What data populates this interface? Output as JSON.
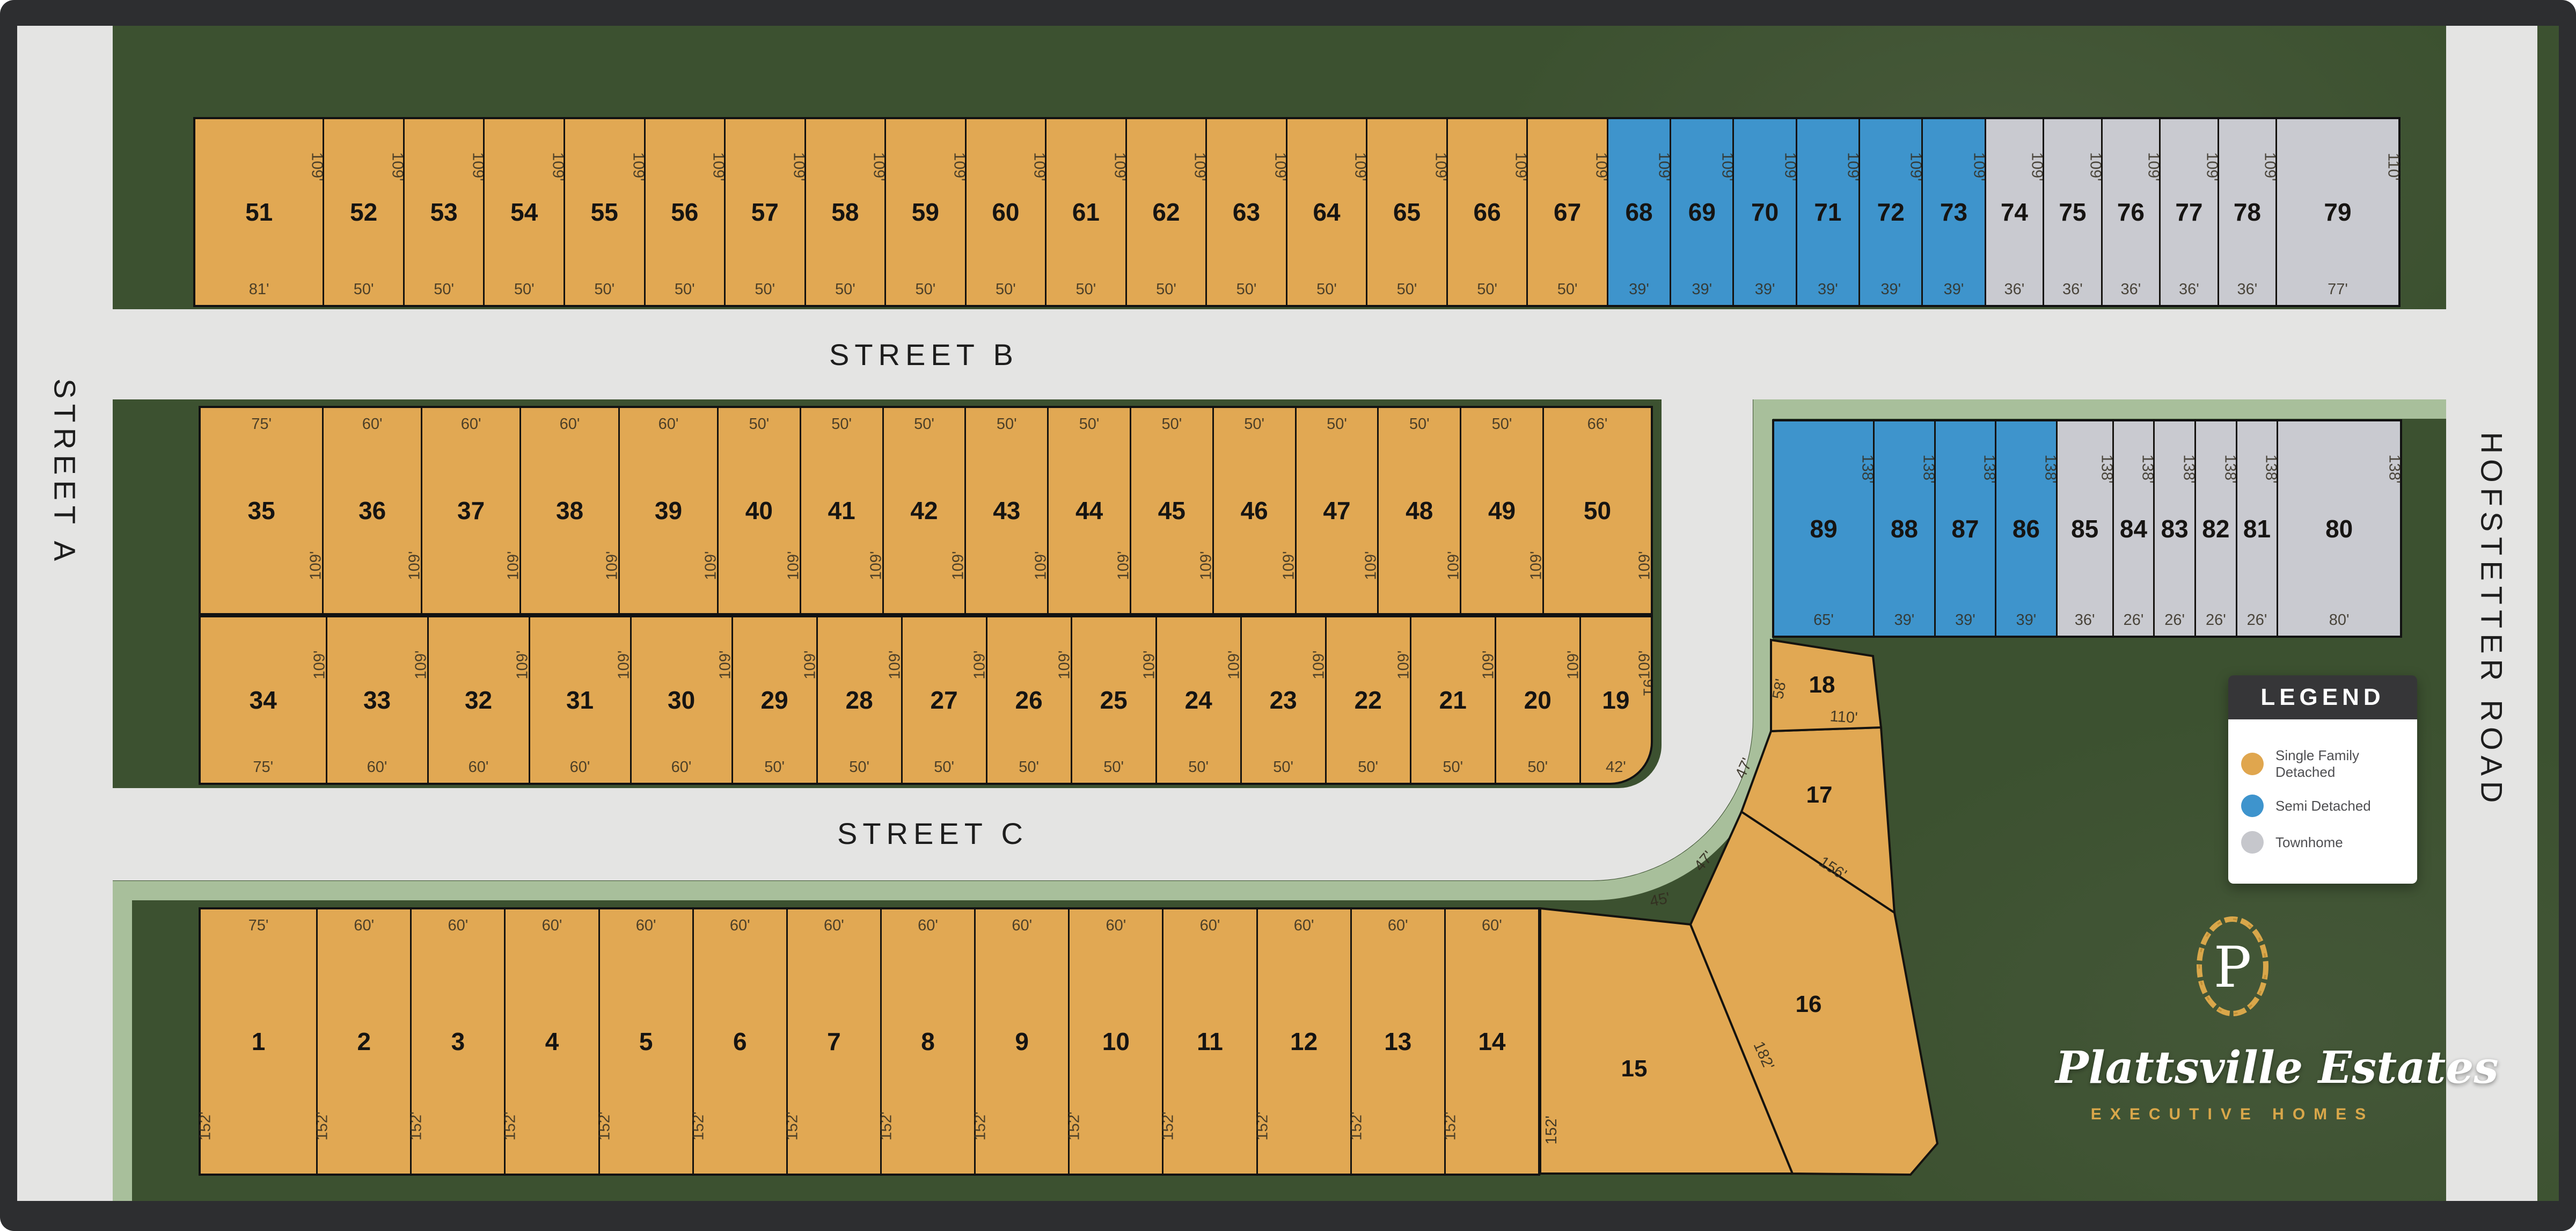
{
  "streets": {
    "a": "STREET A",
    "b": "STREET B",
    "c": "STREET C",
    "hofstetter": "HOFSTETTER ROAD"
  },
  "legend": {
    "title": "LEGEND",
    "items": [
      {
        "label": "Single Family Detached",
        "type": "sfd",
        "color": "#e0a64e"
      },
      {
        "label": "Semi Detached",
        "type": "semi",
        "color": "#3e94cd"
      },
      {
        "label": "Townhome",
        "type": "town",
        "color": "#c6c7cc"
      }
    ]
  },
  "logo": {
    "monogram": "P",
    "name": "Plattsville Estates",
    "tagline": "EXECUTIVE HOMES"
  },
  "colors": {
    "single_family": "#e1a853",
    "semi_detached": "#3e94cc",
    "townhome": "#c9cad0",
    "street": "#e4e4e3",
    "greenbelt": "#a8bf9b",
    "field": "#3c5130",
    "frame": "#2d2e30",
    "gold": "#d9a74a"
  },
  "rows": {
    "north": [
      {
        "n": "51",
        "top": "109'",
        "bottom": "81'",
        "w": 81,
        "t": "sfd"
      },
      {
        "n": "52",
        "top": "109'",
        "bottom": "50'",
        "w": 50,
        "t": "sfd"
      },
      {
        "n": "53",
        "top": "109'",
        "bottom": "50'",
        "w": 50,
        "t": "sfd"
      },
      {
        "n": "54",
        "top": "109'",
        "bottom": "50'",
        "w": 50,
        "t": "sfd"
      },
      {
        "n": "55",
        "top": "109'",
        "bottom": "50'",
        "w": 50,
        "t": "sfd"
      },
      {
        "n": "56",
        "top": "109'",
        "bottom": "50'",
        "w": 50,
        "t": "sfd"
      },
      {
        "n": "57",
        "top": "109'",
        "bottom": "50'",
        "w": 50,
        "t": "sfd"
      },
      {
        "n": "58",
        "top": "109'",
        "bottom": "50'",
        "w": 50,
        "t": "sfd"
      },
      {
        "n": "59",
        "top": "109'",
        "bottom": "50'",
        "w": 50,
        "t": "sfd"
      },
      {
        "n": "60",
        "top": "109'",
        "bottom": "50'",
        "w": 50,
        "t": "sfd"
      },
      {
        "n": "61",
        "top": "109'",
        "bottom": "50'",
        "w": 50,
        "t": "sfd"
      },
      {
        "n": "62",
        "top": "109'",
        "bottom": "50'",
        "w": 50,
        "t": "sfd"
      },
      {
        "n": "63",
        "top": "109'",
        "bottom": "50'",
        "w": 50,
        "t": "sfd"
      },
      {
        "n": "64",
        "top": "109'",
        "bottom": "50'",
        "w": 50,
        "t": "sfd"
      },
      {
        "n": "65",
        "top": "109'",
        "bottom": "50'",
        "w": 50,
        "t": "sfd"
      },
      {
        "n": "66",
        "top": "109'",
        "bottom": "50'",
        "w": 50,
        "t": "sfd"
      },
      {
        "n": "67",
        "top": "109'",
        "bottom": "50'",
        "w": 50,
        "t": "sfd"
      },
      {
        "n": "68",
        "top": "109'",
        "bottom": "39'",
        "w": 39,
        "t": "semi"
      },
      {
        "n": "69",
        "top": "109'",
        "bottom": "39'",
        "w": 39,
        "t": "semi"
      },
      {
        "n": "70",
        "top": "109'",
        "bottom": "39'",
        "w": 39,
        "t": "semi"
      },
      {
        "n": "71",
        "top": "109'",
        "bottom": "39'",
        "w": 39,
        "t": "semi"
      },
      {
        "n": "72",
        "top": "109'",
        "bottom": "39'",
        "w": 39,
        "t": "semi"
      },
      {
        "n": "73",
        "top": "109'",
        "bottom": "39'",
        "w": 39,
        "t": "semi"
      },
      {
        "n": "74",
        "top": "109'",
        "bottom": "36'",
        "w": 36,
        "t": "town"
      },
      {
        "n": "75",
        "top": "109'",
        "bottom": "36'",
        "w": 36,
        "t": "town"
      },
      {
        "n": "76",
        "top": "109'",
        "bottom": "36'",
        "w": 36,
        "t": "town"
      },
      {
        "n": "77",
        "top": "109'",
        "bottom": "36'",
        "w": 36,
        "t": "town"
      },
      {
        "n": "78",
        "top": "109'",
        "bottom": "36'",
        "w": 36,
        "t": "town"
      },
      {
        "n": "79",
        "top": "110'",
        "bottom": "77'",
        "w": 77,
        "t": "town"
      }
    ],
    "midUpper": [
      {
        "n": "35",
        "top": "75'",
        "side": "109'",
        "w": 75,
        "t": "sfd"
      },
      {
        "n": "36",
        "top": "60'",
        "side": "109'",
        "w": 60,
        "t": "sfd"
      },
      {
        "n": "37",
        "top": "60'",
        "side": "109'",
        "w": 60,
        "t": "sfd"
      },
      {
        "n": "38",
        "top": "60'",
        "side": "109'",
        "w": 60,
        "t": "sfd"
      },
      {
        "n": "39",
        "top": "60'",
        "side": "109'",
        "w": 60,
        "t": "sfd"
      },
      {
        "n": "40",
        "top": "50'",
        "side": "109'",
        "w": 50,
        "t": "sfd"
      },
      {
        "n": "41",
        "top": "50'",
        "side": "109'",
        "w": 50,
        "t": "sfd"
      },
      {
        "n": "42",
        "top": "50'",
        "side": "109'",
        "w": 50,
        "t": "sfd"
      },
      {
        "n": "43",
        "top": "50'",
        "side": "109'",
        "w": 50,
        "t": "sfd"
      },
      {
        "n": "44",
        "top": "50'",
        "side": "109'",
        "w": 50,
        "t": "sfd"
      },
      {
        "n": "45",
        "top": "50'",
        "side": "109'",
        "w": 50,
        "t": "sfd"
      },
      {
        "n": "46",
        "top": "50'",
        "side": "109'",
        "w": 50,
        "t": "sfd"
      },
      {
        "n": "47",
        "top": "50'",
        "side": "109'",
        "w": 50,
        "t": "sfd"
      },
      {
        "n": "48",
        "top": "50'",
        "side": "109'",
        "w": 50,
        "t": "sfd"
      },
      {
        "n": "49",
        "top": "50'",
        "side": "109'",
        "w": 50,
        "t": "sfd"
      },
      {
        "n": "50",
        "top": "66'",
        "side": "109'",
        "w": 66,
        "t": "sfd"
      }
    ],
    "midLower": [
      {
        "n": "34",
        "side": "109'",
        "bottom": "75'",
        "w": 75,
        "t": "sfd"
      },
      {
        "n": "33",
        "side": "109'",
        "bottom": "60'",
        "w": 60,
        "t": "sfd"
      },
      {
        "n": "32",
        "side": "109'",
        "bottom": "60'",
        "w": 60,
        "t": "sfd"
      },
      {
        "n": "31",
        "side": "109'",
        "bottom": "60'",
        "w": 60,
        "t": "sfd"
      },
      {
        "n": "30",
        "side": "109'",
        "bottom": "60'",
        "w": 60,
        "t": "sfd"
      },
      {
        "n": "29",
        "side": "109'",
        "bottom": "50'",
        "w": 50,
        "t": "sfd"
      },
      {
        "n": "28",
        "side": "109'",
        "bottom": "50'",
        "w": 50,
        "t": "sfd"
      },
      {
        "n": "27",
        "side": "109'",
        "bottom": "50'",
        "w": 50,
        "t": "sfd"
      },
      {
        "n": "26",
        "side": "109'",
        "bottom": "50'",
        "w": 50,
        "t": "sfd"
      },
      {
        "n": "25",
        "side": "109'",
        "bottom": "50'",
        "w": 50,
        "t": "sfd"
      },
      {
        "n": "24",
        "side": "109'",
        "bottom": "50'",
        "w": 50,
        "t": "sfd"
      },
      {
        "n": "23",
        "side": "109'",
        "bottom": "50'",
        "w": 50,
        "t": "sfd"
      },
      {
        "n": "22",
        "side": "109'",
        "bottom": "50'",
        "w": 50,
        "t": "sfd"
      },
      {
        "n": "21",
        "side": "109'",
        "bottom": "50'",
        "w": 50,
        "t": "sfd"
      },
      {
        "n": "20",
        "side": "109'",
        "bottom": "50'",
        "w": 50,
        "t": "sfd"
      },
      {
        "n": "19",
        "side": "109'",
        "bottom": "42'",
        "right": "91'",
        "w": 42,
        "t": "sfd"
      }
    ],
    "east": [
      {
        "n": "89",
        "side": "138'",
        "bottom": "65'",
        "w": 65,
        "t": "semi"
      },
      {
        "n": "88",
        "side": "138'",
        "bottom": "39'",
        "w": 39,
        "t": "semi"
      },
      {
        "n": "87",
        "side": "138'",
        "bottom": "39'",
        "w": 39,
        "t": "semi"
      },
      {
        "n": "86",
        "side": "138'",
        "bottom": "39'",
        "w": 39,
        "t": "semi"
      },
      {
        "n": "85",
        "side": "138'",
        "bottom": "36'",
        "w": 36,
        "t": "town"
      },
      {
        "n": "84",
        "side": "138'",
        "bottom": "26'",
        "w": 26,
        "t": "town"
      },
      {
        "n": "83",
        "side": "138'",
        "bottom": "26'",
        "w": 26,
        "t": "town"
      },
      {
        "n": "82",
        "side": "138'",
        "bottom": "26'",
        "w": 26,
        "t": "town"
      },
      {
        "n": "81",
        "side": "138'",
        "bottom": "26'",
        "w": 26,
        "t": "town"
      },
      {
        "n": "80",
        "side": "138'",
        "bottom": "80'",
        "w": 80,
        "t": "town"
      }
    ],
    "south": [
      {
        "n": "1",
        "top": "75'",
        "left": "152'",
        "w": 75,
        "t": "sfd"
      },
      {
        "n": "2",
        "top": "60'",
        "left": "152'",
        "w": 60,
        "t": "sfd"
      },
      {
        "n": "3",
        "top": "60'",
        "left": "152'",
        "w": 60,
        "t": "sfd"
      },
      {
        "n": "4",
        "top": "60'",
        "left": "152'",
        "w": 60,
        "t": "sfd"
      },
      {
        "n": "5",
        "top": "60'",
        "left": "152'",
        "w": 60,
        "t": "sfd"
      },
      {
        "n": "6",
        "top": "60'",
        "left": "152'",
        "w": 60,
        "t": "sfd"
      },
      {
        "n": "7",
        "top": "60'",
        "left": "152'",
        "w": 60,
        "t": "sfd"
      },
      {
        "n": "8",
        "top": "60'",
        "left": "152'",
        "w": 60,
        "t": "sfd"
      },
      {
        "n": "9",
        "top": "60'",
        "left": "152'",
        "w": 60,
        "t": "sfd"
      },
      {
        "n": "10",
        "top": "60'",
        "left": "152'",
        "w": 60,
        "t": "sfd"
      },
      {
        "n": "11",
        "top": "60'",
        "left": "152'",
        "w": 60,
        "t": "sfd"
      },
      {
        "n": "12",
        "top": "60'",
        "left": "152'",
        "w": 60,
        "t": "sfd"
      },
      {
        "n": "13",
        "top": "60'",
        "left": "152'",
        "w": 60,
        "t": "sfd"
      },
      {
        "n": "14",
        "top": "60'",
        "left": "152'",
        "w": 60,
        "t": "sfd"
      }
    ]
  },
  "se": {
    "l15": {
      "n": "15",
      "dim_top": "45'",
      "dim_left": "152'"
    },
    "l16": {
      "n": "16",
      "dim_curve": "47'",
      "dim_ne": "156'",
      "dim_w": "182'"
    },
    "l17": {
      "n": "17",
      "dim_curve": "47'"
    },
    "l18": {
      "n": "18",
      "dim_left": "58'",
      "dim_bottom": "110'"
    }
  }
}
